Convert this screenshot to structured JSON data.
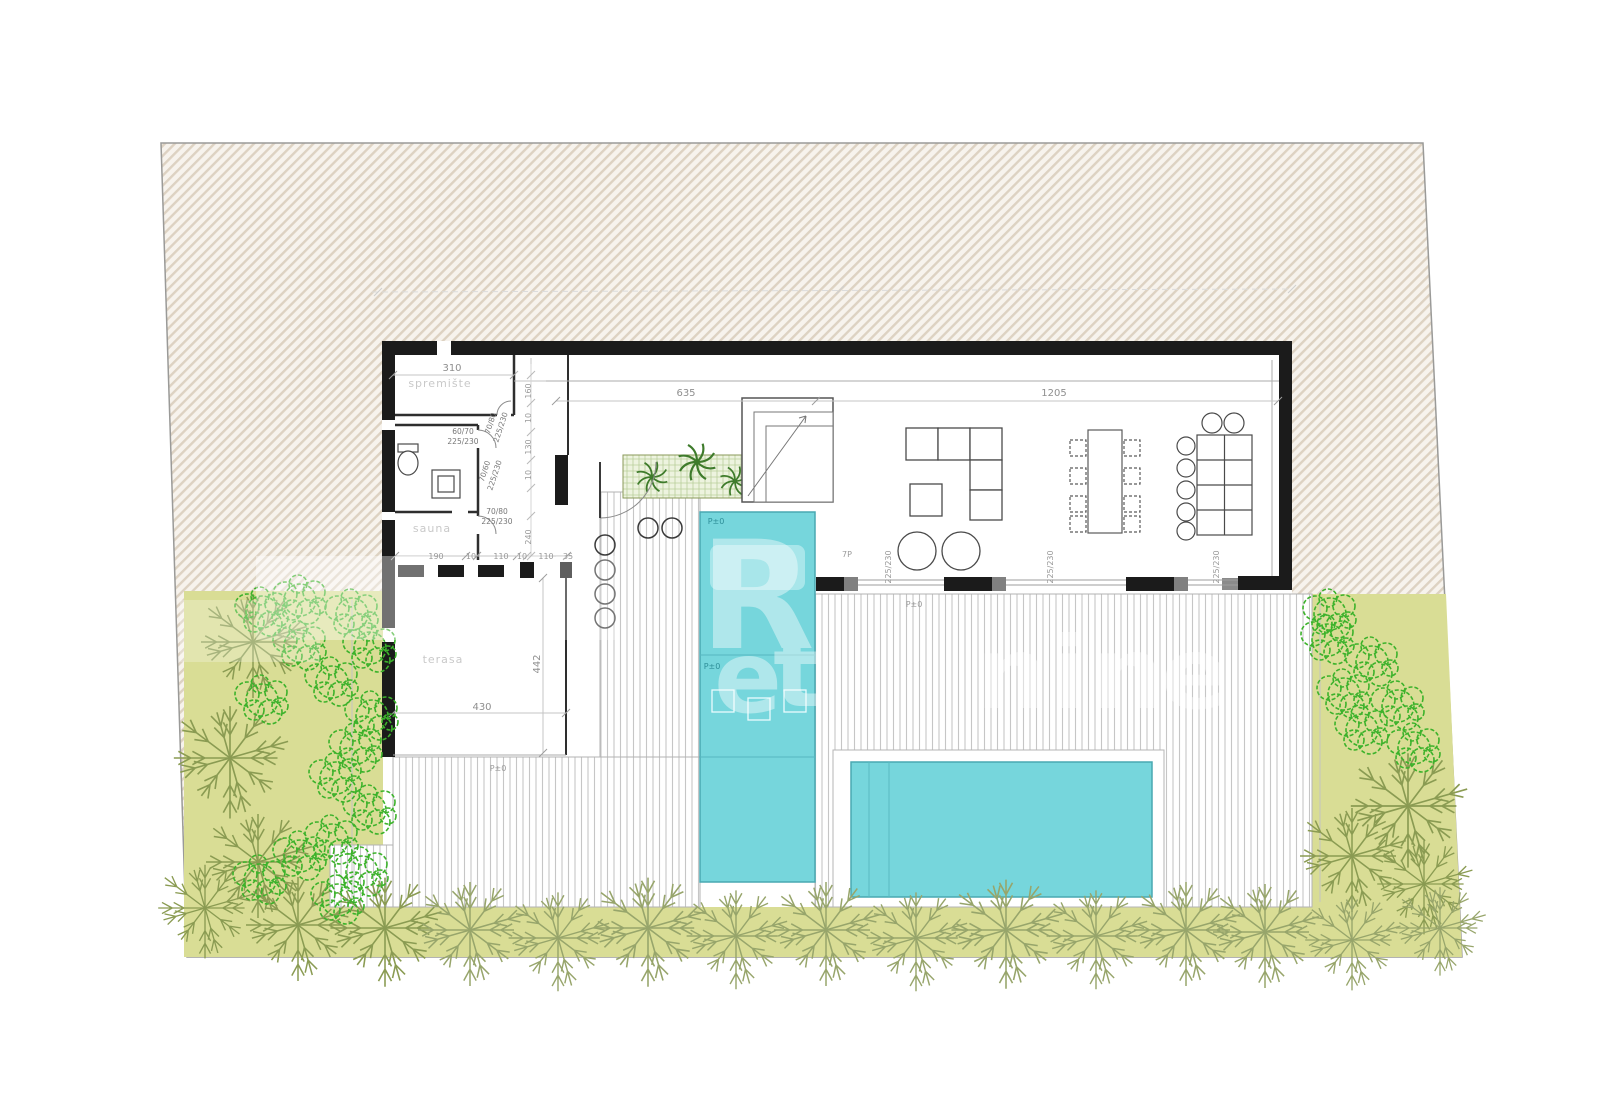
{
  "plan": {
    "colors": {
      "plot_hatch_stripe": "#ddd2c2",
      "plot_hatch_bg": "#f7f3ed",
      "wall_black": "#1b1b1b",
      "pool_fill": "#76d6dc",
      "pool_shelf": "#a8e6ea",
      "pool_stroke": "#49a8b2",
      "garden_green": "#d9dd95",
      "tree_olive": "#8a9b52",
      "hedge_olive": "#97a56b",
      "shrub_bright": "#3cb22b",
      "deck_line": "#c6c6c6"
    },
    "room_labels": [
      {
        "text": "spremište",
        "x": 440,
        "y": 387
      },
      {
        "text": "sauna",
        "x": 432,
        "y": 532
      },
      {
        "text": "terasa",
        "x": 443,
        "y": 663
      }
    ],
    "dimensions": [
      {
        "text": "310",
        "x": 452,
        "y": 371,
        "rot": 0,
        "cls": "dim"
      },
      {
        "text": "635",
        "x": 686,
        "y": 396,
        "rot": 0,
        "cls": "dim"
      },
      {
        "text": "1205",
        "x": 1054,
        "y": 396,
        "rot": 0,
        "cls": "dim"
      },
      {
        "text": "160",
        "x": 531,
        "y": 391,
        "rot": -90,
        "cls": "dim-sm"
      },
      {
        "text": "10",
        "x": 531,
        "y": 418,
        "rot": -90,
        "cls": "dim-sm"
      },
      {
        "text": "130",
        "x": 531,
        "y": 447,
        "rot": -90,
        "cls": "dim-sm"
      },
      {
        "text": "10",
        "x": 531,
        "y": 475,
        "rot": -90,
        "cls": "dim-sm"
      },
      {
        "text": "240",
        "x": 531,
        "y": 537,
        "rot": -90,
        "cls": "dim-sm"
      },
      {
        "text": "190",
        "x": 436,
        "y": 559,
        "rot": 0,
        "cls": "dim-sm"
      },
      {
        "text": "10",
        "x": 471,
        "y": 559,
        "rot": 0,
        "cls": "dim-sm"
      },
      {
        "text": "110",
        "x": 501,
        "y": 559,
        "rot": 0,
        "cls": "dim-sm"
      },
      {
        "text": "10",
        "x": 522,
        "y": 559,
        "rot": 0,
        "cls": "dim-sm"
      },
      {
        "text": "110",
        "x": 546,
        "y": 559,
        "rot": 0,
        "cls": "dim-sm"
      },
      {
        "text": "35",
        "x": 568,
        "y": 559,
        "rot": 0,
        "cls": "dim-sm"
      },
      {
        "text": "442",
        "x": 540,
        "y": 664,
        "rot": -90,
        "cls": "dim"
      },
      {
        "text": "430",
        "x": 482,
        "y": 710,
        "rot": 0,
        "cls": "dim"
      },
      {
        "text": "225/230",
        "x": 891,
        "y": 567,
        "rot": -90,
        "cls": "dim-sm"
      },
      {
        "text": "225/230",
        "x": 1053,
        "y": 567,
        "rot": -90,
        "cls": "dim-sm"
      },
      {
        "text": "225/230",
        "x": 1219,
        "y": 567,
        "rot": -90,
        "cls": "dim-sm"
      }
    ],
    "door_specs": [
      {
        "text": "70/80",
        "x": 493,
        "y": 424,
        "rot": -72
      },
      {
        "text": "225/230",
        "x": 503,
        "y": 428,
        "rot": -72
      },
      {
        "text": "60/70",
        "x": 463,
        "y": 434,
        "rot": 0
      },
      {
        "text": "225/230",
        "x": 463,
        "y": 444,
        "rot": 0
      },
      {
        "text": "70/60",
        "x": 487,
        "y": 472,
        "rot": -72
      },
      {
        "text": "225/230",
        "x": 497,
        "y": 476,
        "rot": -72
      },
      {
        "text": "70/80",
        "x": 497,
        "y": 514,
        "rot": 0
      },
      {
        "text": "225/230",
        "x": 497,
        "y": 524,
        "rot": 0
      }
    ],
    "level_marks": [
      {
        "text": "P±0",
        "x": 716,
        "y": 524,
        "cls": "lvl-pool"
      },
      {
        "text": "P±0",
        "x": 712,
        "y": 669,
        "cls": "lvl-pool"
      },
      {
        "text": "P±0",
        "x": 914,
        "y": 607,
        "cls": "lvl"
      },
      {
        "text": "P±0",
        "x": 498,
        "y": 771,
        "cls": "lvl"
      },
      {
        "text": "7P",
        "x": 847,
        "y": 557,
        "cls": "lvl"
      }
    ],
    "watermark": {
      "primary_letter": "R",
      "letters": [
        {
          "ch": "e",
          "x": 748,
          "y": 712
        },
        {
          "ch": "t",
          "x": 797,
          "y": 706
        },
        {
          "ch": "n",
          "x": 1012,
          "y": 708
        },
        {
          "ch": "i",
          "x": 1070,
          "y": 708
        },
        {
          "ch": "n",
          "x": 1128,
          "y": 708
        },
        {
          "ch": "e",
          "x": 1195,
          "y": 708
        }
      ]
    }
  }
}
